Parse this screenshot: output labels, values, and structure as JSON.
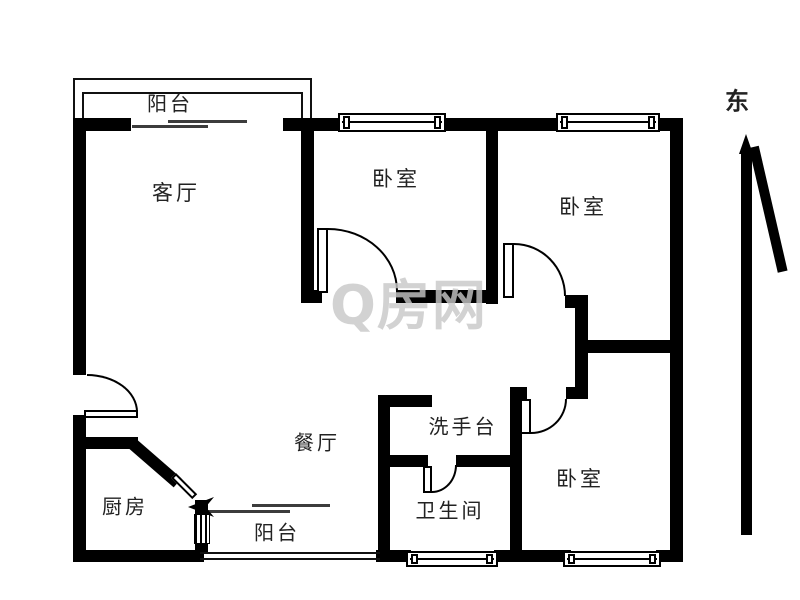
{
  "colors": {
    "background": "#ffffff",
    "wall": "#000000",
    "label": "#222222",
    "watermark": "#c8c8c8"
  },
  "rooms": [
    {
      "id": "balcony-top",
      "label": "阳台"
    },
    {
      "id": "living-room",
      "label": "客厅"
    },
    {
      "id": "bedroom-north",
      "label": "卧室"
    },
    {
      "id": "bedroom-east",
      "label": "卧室"
    },
    {
      "id": "dining-room",
      "label": "餐厅"
    },
    {
      "id": "wash-basin",
      "label": "洗手台"
    },
    {
      "id": "bathroom",
      "label": "卫生间"
    },
    {
      "id": "bedroom-southeast",
      "label": "卧室"
    },
    {
      "id": "kitchen",
      "label": "厨房"
    },
    {
      "id": "balcony-bottom",
      "label": "阳台"
    }
  ],
  "compass": {
    "label": "东",
    "direction": "east"
  },
  "watermark": {
    "text": "Q房网"
  }
}
